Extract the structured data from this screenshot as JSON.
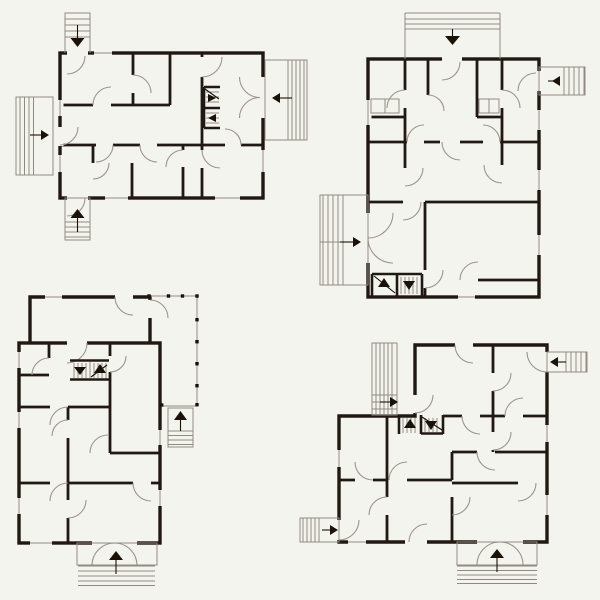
{
  "meta": {
    "description": "Architectural plan: set of four black-and-white apartment floor plan blueprints in top view, vector drawing style on a light background",
    "plan_count": 4
  },
  "colors": {
    "bg": "#f4f4ef",
    "wall": "#201812",
    "ink": "#181208",
    "thin": "#8f8b80",
    "arc": "#9a958a"
  },
  "plans": [
    {
      "id": "plan-top-left",
      "position": "top-left",
      "external_stairs": [
        {
          "side": "top",
          "arrow": "down"
        },
        {
          "side": "left",
          "arrow": "right"
        },
        {
          "side": "right",
          "arrow": "left"
        },
        {
          "side": "bottom",
          "arrow": "up"
        }
      ],
      "internal_staircase": {
        "present": true,
        "arrows": [
          "right",
          "left"
        ]
      },
      "double_door_sides": [
        "right"
      ],
      "rooms_approx": 8
    },
    {
      "id": "plan-top-right",
      "position": "top-right",
      "external_stairs": [
        {
          "side": "top",
          "arrow": "down"
        },
        {
          "side": "right",
          "arrow": "left"
        },
        {
          "side": "left",
          "arrow": "right"
        }
      ],
      "internal_staircase": {
        "present": true,
        "arrows": [
          "up",
          "down"
        ]
      },
      "double_door_sides": [
        "left"
      ],
      "rooms_approx": 9
    },
    {
      "id": "plan-bottom-left",
      "position": "bottom-left",
      "external_stairs": [
        {
          "side": "right",
          "arrow": "up"
        },
        {
          "side": "bottom",
          "arrow": "up"
        }
      ],
      "internal_staircase": {
        "present": true,
        "arrows": [
          "down",
          "up"
        ]
      },
      "double_door_sides": [
        "bottom"
      ],
      "porch": {
        "present": true,
        "post_count": 10
      },
      "rooms_approx": 8
    },
    {
      "id": "plan-bottom-right",
      "position": "bottom-right",
      "external_stairs": [
        {
          "side": "top-left",
          "arrow": "right"
        },
        {
          "side": "right",
          "arrow": "left"
        },
        {
          "side": "left",
          "arrow": "right"
        },
        {
          "side": "bottom",
          "arrow": "up"
        }
      ],
      "internal_staircase": {
        "present": true,
        "arrows": [
          "up",
          "down"
        ]
      },
      "double_door_sides": [
        "bottom"
      ],
      "rooms_approx": 9
    }
  ]
}
